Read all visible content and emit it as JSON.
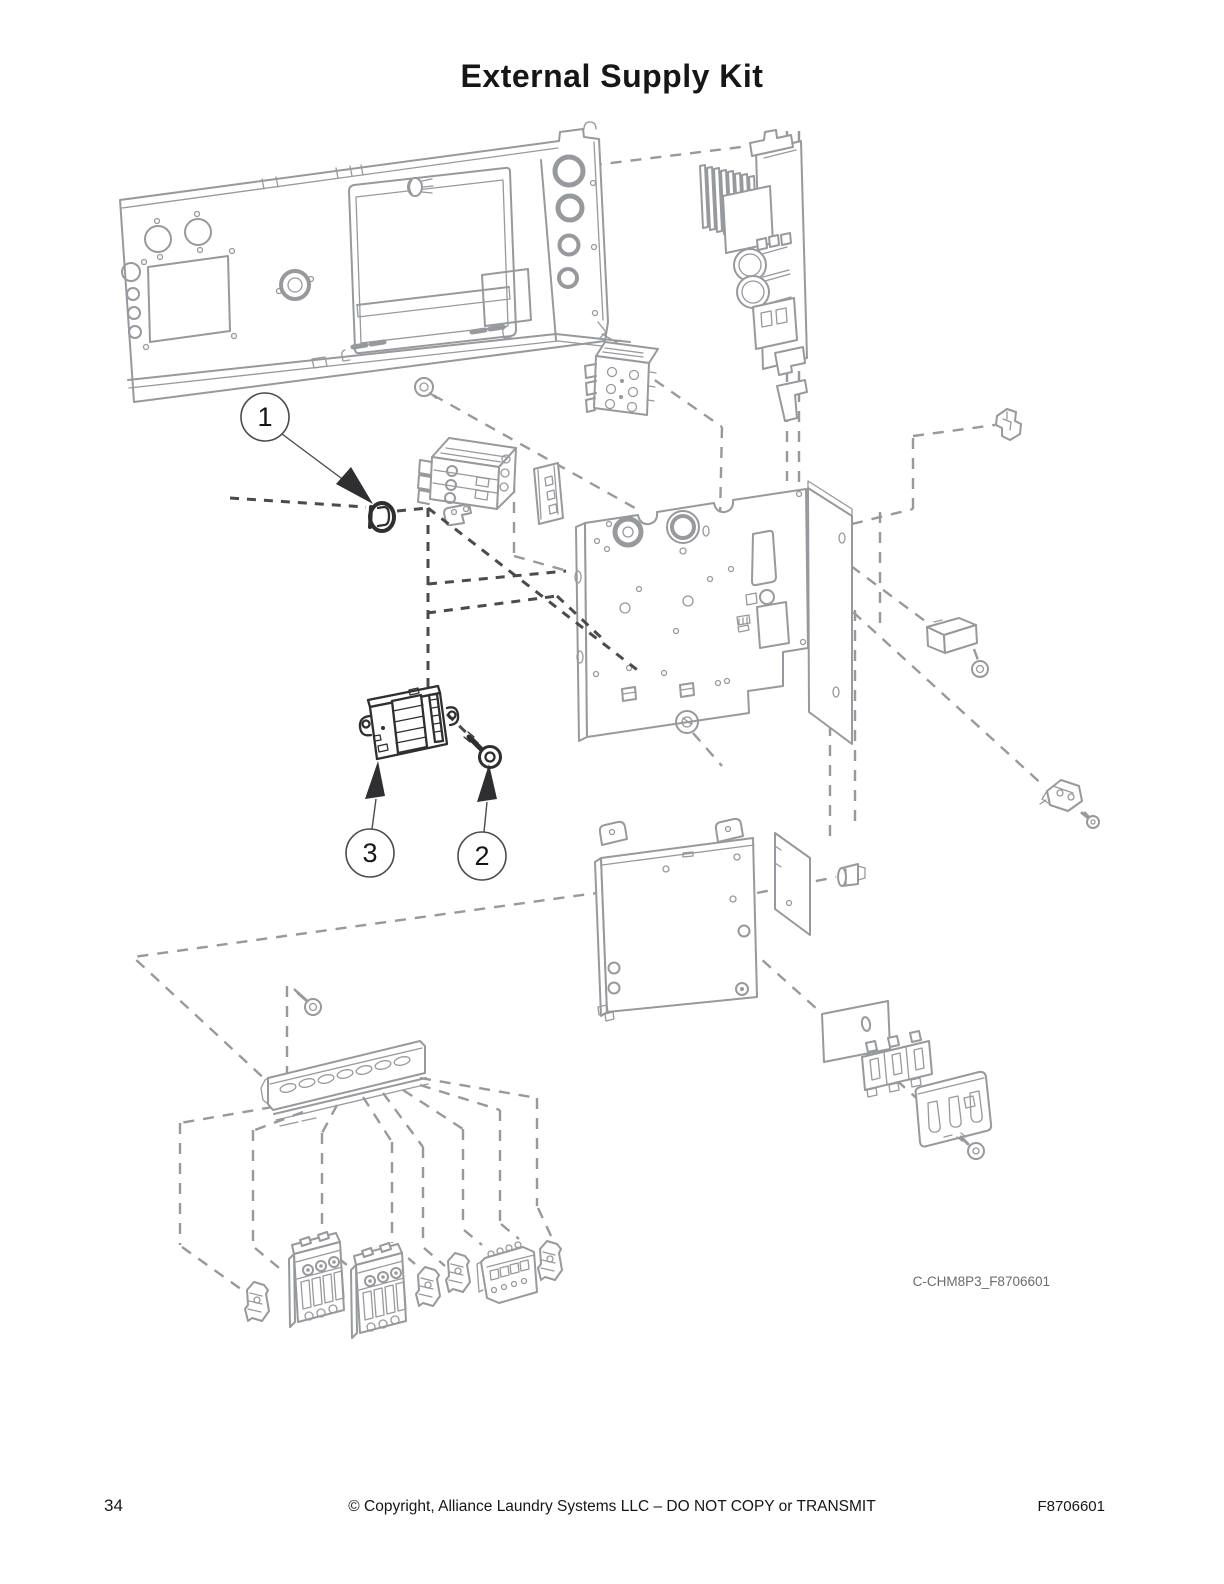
{
  "page": {
    "title": "External Supply Kit"
  },
  "diagram": {
    "code_label": "C-CHM8P3_F8706601",
    "callouts": [
      {
        "number": "1"
      },
      {
        "number": "2"
      },
      {
        "number": "3"
      }
    ]
  },
  "footer": {
    "page_number": "34",
    "copyright": "© Copyright, Alliance Laundry Systems LLC – DO NOT COPY or TRANSMIT",
    "document_number": "F8706601"
  },
  "colors": {
    "line_gray": "#97999c",
    "dash_dark": "#4b4b4d",
    "dark_part": "#2f2f31",
    "text_dark": "#161616",
    "code_gray": "#6a6c6e"
  }
}
